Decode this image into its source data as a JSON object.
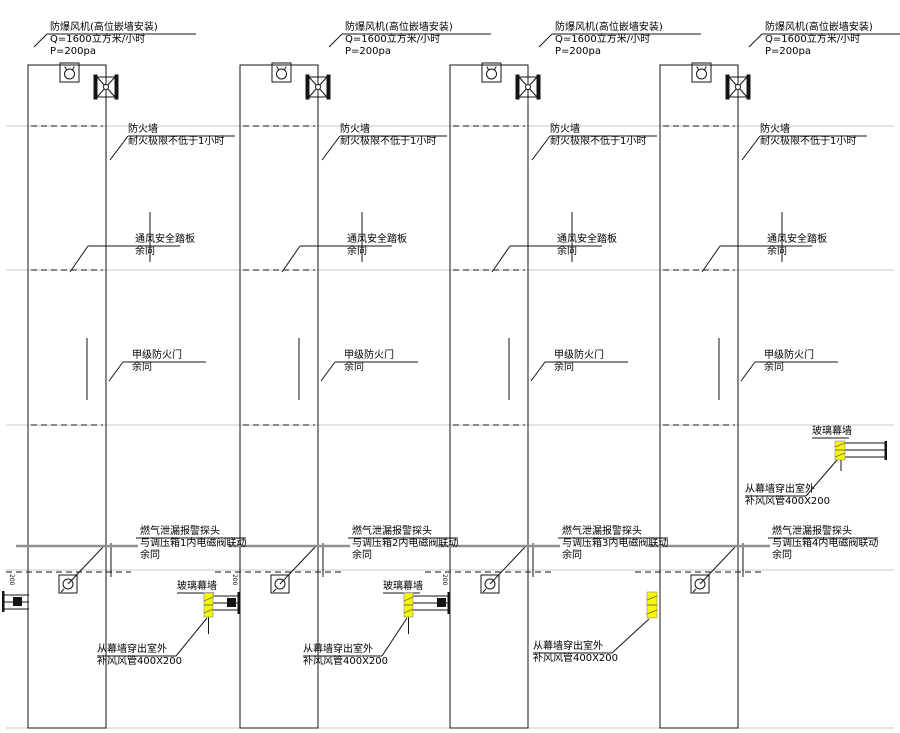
{
  "drawing": {
    "title": "燃气调压箱竖井通风系统图",
    "background": "#ffffff",
    "line_color": "#141414",
    "grid_color": "#c8c8c8",
    "highlight_color": "#f8f800"
  },
  "shared": {
    "fan_spec_title": "防爆风机(高位嵌墙安装)",
    "fan_spec_q": "Q=1600立方米/小时",
    "fan_spec_p": "P=200pa",
    "firewall_title": "防火墙",
    "firewall_note": "耐火极限不低于1小时",
    "vent_title": "通风安全踏板",
    "same_as_rest": "余同",
    "fire_door_title": "甲级防火门",
    "gas_probe_title": "燃气泄漏报警探头",
    "curtain_wall": "玻璃幕墙",
    "duct_exit_line1": "从幕墙穿出室外",
    "duct_exit_line2": "补风风管400X200",
    "duct_size": "200"
  },
  "columns": [
    {
      "index": 1,
      "gas_probe_link": "与调压箱1内电磁阀联动"
    },
    {
      "index": 2,
      "gas_probe_link": "与调压箱2内电磁阀联动"
    },
    {
      "index": 3,
      "gas_probe_link": "与调压箱3内电磁阀联动"
    },
    {
      "index": 4,
      "gas_probe_link": "与调压箱4内电磁阀联动"
    }
  ]
}
